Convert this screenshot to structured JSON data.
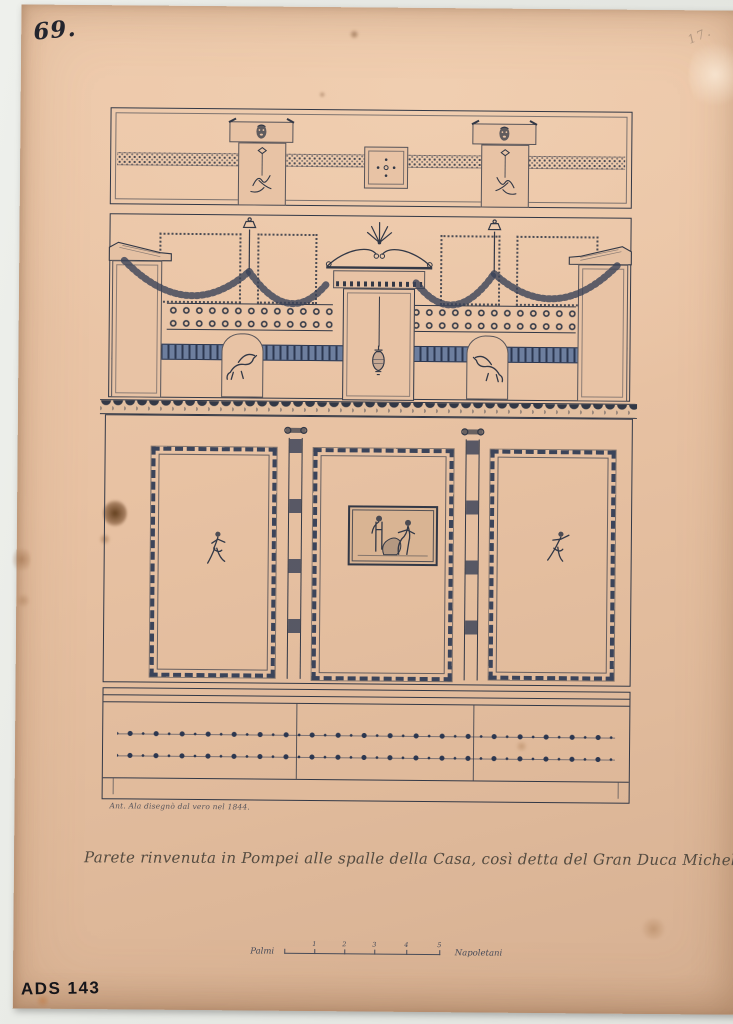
{
  "scan": {
    "background_color": "#e7e9e4",
    "paper_color": "#e9c5a7",
    "ink_color": "#323846",
    "band_blue_color": "#6d7e9e"
  },
  "annotations": {
    "page_number": "69.",
    "corner_mark": "17.",
    "archive_code": "ADS 143"
  },
  "drawing": {
    "subject": "Wall elevation in three registers with attic masks, garlands, central aedicula with hanging amphora, griffins, three bordered panels (flying figures and central pinax) and rosette dado",
    "signature": "Ant. Ala disegnò dal vero nel 1844.",
    "caption": "Parete rinvenuta in Pompei alle spalle della Casa, così detta del Gran Duca Michele",
    "scale_bar": {
      "left_label": "Palmi",
      "right_label": "Napoletani",
      "ticks": [
        "1",
        "2",
        "3",
        "4",
        "5"
      ]
    },
    "icons": [
      "theatre-mask-icon",
      "hanging-ornament-icon",
      "quincunx-dots-icon",
      "candelabrum-icon",
      "garland-swag-icon",
      "cornice-icon",
      "anthemion-icon",
      "pediment-icon",
      "hanging-amphora-icon",
      "griffin-icon",
      "pilaster-capital-icon",
      "flying-figure-icon",
      "pinax-scene-icon"
    ]
  }
}
